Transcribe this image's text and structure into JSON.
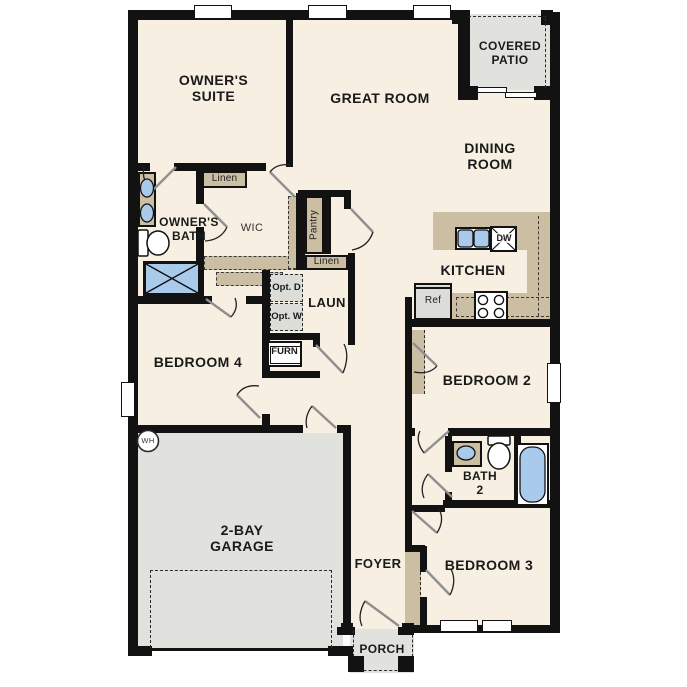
{
  "colors": {
    "wall": "#121212",
    "room_fill": "#F6EFE2",
    "counter_tan": "#CBBEA3",
    "garage_gray": "#E1E1DE",
    "appliance_gray": "#DCDCD9",
    "fixture_blue": "#A9CAEB",
    "background": "#FFFFFF"
  },
  "rooms": {
    "owners_suite": "OWNER'S SUITE",
    "great_room": "GREAT ROOM",
    "covered_patio": "COVERED PATIO",
    "dining_room": "DINING ROOM",
    "kitchen": "KITCHEN",
    "owners_bath": "OWNER'S BATH",
    "wic": "WIC",
    "laundry": "LAUN",
    "bedroom4": "BEDROOM 4",
    "bedroom2": "BEDROOM 2",
    "bath2": "BATH 2",
    "bedroom3": "BEDROOM 3",
    "garage": "2-BAY GARAGE",
    "foyer": "FOYER",
    "porch": "PORCH"
  },
  "labels": {
    "linen_top": "Linen",
    "linen_hall": "Linen",
    "pantry": "Pantry",
    "opt_dryer": "Opt. D",
    "opt_washer": "Opt. W",
    "furnace": "FURN",
    "refrigerator": "Ref",
    "dishwasher": "DW",
    "water_heater": "WH"
  }
}
